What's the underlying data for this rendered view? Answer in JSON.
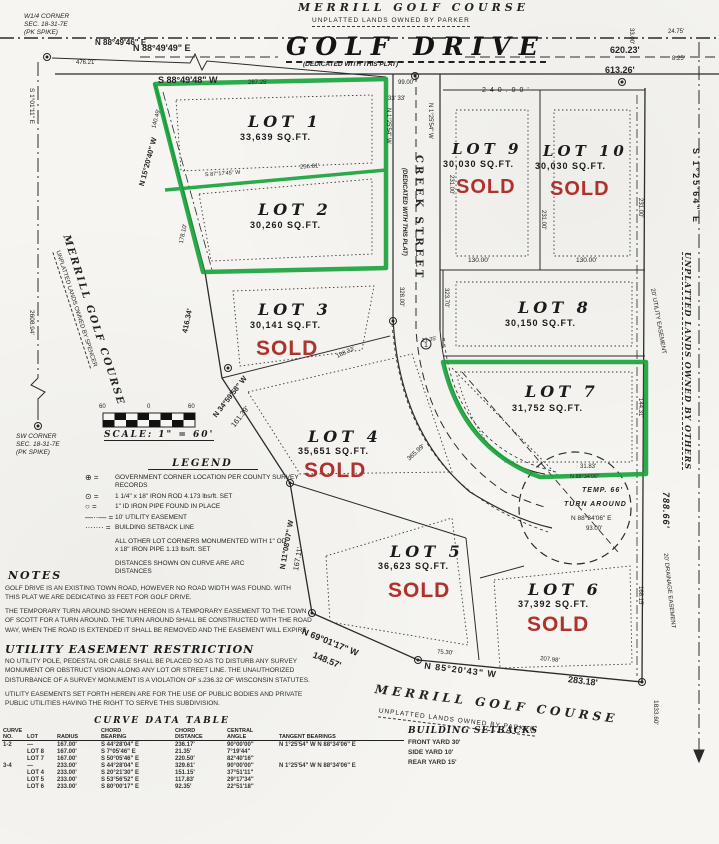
{
  "colors": {
    "green": "#17a23a",
    "red": "#ae322d",
    "ink": "#2b2b2b",
    "paper": "#f6f5f1"
  },
  "owners": {
    "top1": "MERRILL GOLF COURSE",
    "top2": "UNPLATTED LANDS OWNED BY PARKER",
    "left1": "MERRILL GOLF COURSE",
    "left2": "UNPLATTED LANDS OWNED BY SPENCER",
    "bottom1": "MERRILL GOLF COURSE",
    "bottom2": "UNPLATTED LANDS OWNED BY PARKER",
    "right1": "UNPLATTED LANDS OWNED BY OTHERS"
  },
  "corners": {
    "w14": "W1/4 CORNER\nSEC. 18-31-7E\n(PK SPIKE)",
    "sw": "SW CORNER\nSEC. 18-31-7E\n(PK SPIKE)"
  },
  "roads": {
    "golf": "GOLF DRIVE",
    "golf_sub": "(DEDICATED WITH THIS PLAT)",
    "creek": "CREEK STREET",
    "creek_sub": "(DEDICATED WITH THIS PLAT)"
  },
  "labels": {
    "b_golf_n": "N 88°49'49\" E",
    "d_golf_n": "620.23'",
    "b_golf_s": "S 88°49'48\" W",
    "d_golf_s": "613.26'",
    "b_nw": "N 88°49'46\" E",
    "d_nw": "476.21'",
    "d_287": "287.25'",
    "d_99": "99.00'",
    "d_3333": "33'  33'",
    "d_240": "240.00'",
    "d_2475": "24.75'",
    "d_825": "8.25'",
    "d_3300": "33.00'",
    "b_se_top": "S 1°25'64\" E",
    "d_231a": "231.00'",
    "d_231b": "231.00'",
    "d_231c": "231.00'",
    "d_130a": "130.00'",
    "d_130b": "130.00'",
    "b_creek_w": "N 1°25'54\" W",
    "b_creek_e": "N 1°25'54\" W",
    "d_32800": "328.00'",
    "d_32370": "323.70'",
    "b_left_green": "N 15°20'40\" W",
    "d_14049": "140.49'",
    "d_17810": "178.10'",
    "b_lot12": "S 87°17'45\" W",
    "d_25681": "256.81'",
    "d_41634": "416.34'",
    "b_3459": "N 34°59'58\" W",
    "d_16139": "161.39'",
    "b_1108": "N 11°08'07\" W",
    "d_16711": "167.11'",
    "b_6901": "N 69°01'17\" W",
    "d_14857": "148.57'",
    "b_8520": "N 85°20'43\" W",
    "d_28318": "283.18'",
    "d_20798": "207.98'",
    "d_7530": "75.30'",
    "d_36599": "365.99'",
    "d_18833": "188.33'",
    "d_2135": "21.35'",
    "d_3183": "31.83'",
    "b_8834a": "N 88°34'06\"",
    "temp": "TEMP. 66'",
    "turn": "TURN AROUND",
    "b_8834": "N 88°34'06\" E",
    "d_9300": "93.00'",
    "d_14431": "144.31'",
    "d_78866": "788.66'",
    "d_16815": "168.15'",
    "d_183360": "1833.60'",
    "ease_util": "20' UTILITY EASEMENT",
    "ease_drain": "20' DRAINAGE EASEMENT",
    "b_left_sec": "S 1°01'11\" E",
    "d_260894": "2608.94'"
  },
  "scale": {
    "t1": "60",
    "t2": "0",
    "t3": "60",
    "label": "SCALE: 1\" = 60'"
  },
  "legend": {
    "title": "LEGEND",
    "items": [
      {
        "sym": "⊕ =",
        "text": "GOVERNMENT CORNER LOCATION PER COUNTY SURVEY RECORDS"
      },
      {
        "sym": "⊙ =",
        "text": "1 1/4\" x 18\" IRON ROD 4.173 lbs/ft. SET"
      },
      {
        "sym": "○ =",
        "text": "1\" ID IRON PIPE FOUND IN PLACE"
      },
      {
        "sym": "—··— =",
        "text": "10' UTILITY EASEMENT"
      },
      {
        "sym": "······· =",
        "text": "BUILDING SETBACK LINE"
      }
    ],
    "note1": "ALL OTHER LOT CORNERS MONUMENTED WITH 1\" OD x 18\" IRON PIPE 1.13 lbs/ft. SET",
    "note2": "DISTANCES SHOWN ON CURVE ARE ARC DISTANCES"
  },
  "notes": {
    "title": "NOTES",
    "p1": "GOLF DRIVE IS AN EXISTING TOWN ROAD, HOWEVER NO ROAD WIDTH WAS FOUND. WITH THIS PLAT WE ARE DEDICATING 33 FEET FOR GOLF DRIVE.",
    "p2": "THE TEMPORARY TURN AROUND SHOWN HEREON IS A TEMPORARY EASEMENT TO THE TOWN OF SCOTT FOR A TURN AROUND. THE TURN AROUND SHALL BE CONSTRUCTED WITH THE ROAD WAY, WHEN THE ROAD IS EXTENDED IT SHALL BE REMOVED AND THE EASEMENT WILL EXPIRE."
  },
  "utility": {
    "title": "UTILITY EASEMENT RESTRICTION",
    "p1": "NO UTILITY POLE, PEDESTAL OR CABLE SHALL BE PLACED SO AS TO DISTURB ANY SURVEY MONUMENT OR OBSTRUCT VISION ALONG ANY LOT OR STREET LINE. THE UNAUTHORIZED DISTURBANCE OF A SURVEY MONUMENT IS A VIOLATION OF s.236.32 OF WISCONSIN STATUTES.",
    "p2": "UTILITY EASEMENTS SET FORTH HEREIN ARE FOR THE USE OF PUBLIC BODIES AND PRIVATE PUBLIC UTILITIES HAVING THE RIGHT TO SERVE THIS SUBDIVISION."
  },
  "curve_table": {
    "title": "CURVE DATA TABLE",
    "headers": [
      "CURVE\nNO.",
      "LOT",
      "RADIUS",
      "CHORD\nBEARING",
      "CHORD\nDISTANCE",
      "CENTRAL\nANGLE",
      "TANGENT BEARINGS"
    ],
    "rows": [
      [
        "1-2",
        "—",
        "167.00'",
        "S 44°28'04\" E",
        "236.17'",
        "90°00'00\"",
        "N 1°25'54\" W   N 88°34'06\" E"
      ],
      [
        "",
        "LOT 8",
        "167.00'",
        "S 7°05'46\" E",
        "21.35'",
        "7°19'44\"",
        ""
      ],
      [
        "",
        "LOT 7",
        "167.00'",
        "S 50°05'46\" E",
        "220.50'",
        "82°40'16\"",
        ""
      ],
      [
        "3-4",
        "—",
        "233.00'",
        "S 44°28'04\" E",
        "329.61'",
        "90°00'00\"",
        "N 1°25'54\" W   N 88°34'06\" E"
      ],
      [
        "",
        "LOT 4",
        "233.00'",
        "S 20°21'30\" E",
        "151.15'",
        "37°51'11\"",
        ""
      ],
      [
        "",
        "LOT 5",
        "233.00'",
        "S 53°56'52\" E",
        "117.83'",
        "29°17'34\"",
        ""
      ],
      [
        "",
        "LOT 6",
        "233.00'",
        "S 80°00'17\" E",
        "92.35'",
        "22°51'18\"",
        ""
      ]
    ]
  },
  "setbacks": {
    "title": "BUILDING SETBACKS",
    "rows": [
      "FRONT YARD 30'",
      "SIDE YARD 10'",
      "REAR YARD 15'"
    ]
  },
  "lots": [
    {
      "name": "LOT 1",
      "area": "33,639 SQ.FT.",
      "status": "",
      "highlighted": true
    },
    {
      "name": "LOT 2",
      "area": "30,260 SQ.FT.",
      "status": "",
      "highlighted": true
    },
    {
      "name": "LOT 3",
      "area": "30,141 SQ.FT.",
      "status": "SOLD",
      "highlighted": false
    },
    {
      "name": "LOT 4",
      "area": "35,651 SQ.FT.",
      "status": "SOLD",
      "highlighted": false
    },
    {
      "name": "LOT 5",
      "area": "36,623 SQ.FT.",
      "status": "SOLD",
      "highlighted": false
    },
    {
      "name": "LOT 6",
      "area": "37,392 SQ.FT.",
      "status": "SOLD",
      "highlighted": false
    },
    {
      "name": "LOT 7",
      "area": "31,752 SQ.FT.",
      "status": "",
      "highlighted": true
    },
    {
      "name": "LOT 8",
      "area": "30,150 SQ.FT.",
      "status": "",
      "highlighted": false
    },
    {
      "name": "LOT 9",
      "area": "30,030 SQ.FT.",
      "status": "SOLD",
      "highlighted": false
    },
    {
      "name": "LOT 10",
      "area": "30,030 SQ.FT.",
      "status": "SOLD",
      "highlighted": false
    }
  ]
}
